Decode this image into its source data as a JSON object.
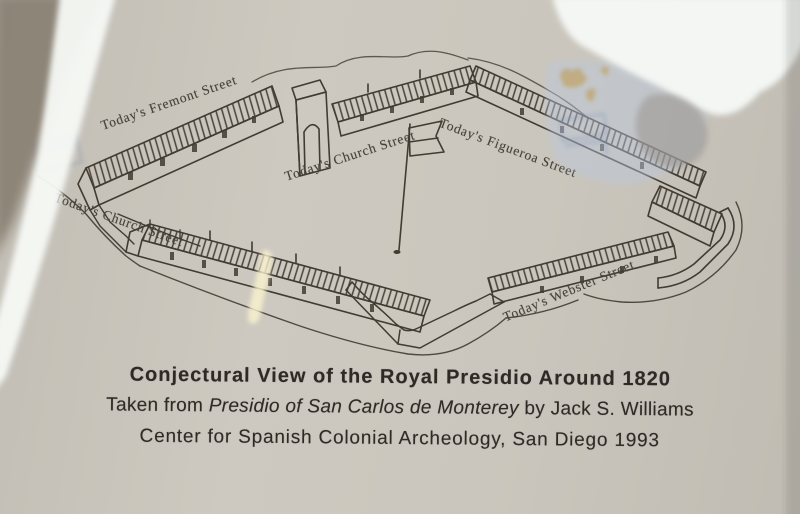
{
  "caption": {
    "title": "Conjectural View of the Royal Presidio Around 1820",
    "source_prefix": "Taken from ",
    "book_title": "Presidio of San Carlos de Monterey",
    "source_suffix": " by Jack S. Williams",
    "publisher_line": "Center for Spanish Colonial Archeology, San Diego 1993"
  },
  "streets": [
    {
      "id": "fremont",
      "text": "Today's Fremont Street"
    },
    {
      "id": "church-upper",
      "text": "Today's Church Street"
    },
    {
      "id": "figueroa",
      "text": "Today's Figueroa Street"
    },
    {
      "id": "church-lower-left",
      "text": "Today's Church Street"
    },
    {
      "id": "webster",
      "text": "Today's Webster Street"
    }
  ],
  "colors": {
    "paper": "#c9c5bc",
    "ink": "#413b33",
    "reflection_white": "#f5f8f5",
    "reflection_blue": "#bac8dc",
    "shadow_brown": "#8b8275",
    "streak_yellow": "#faf2ce"
  }
}
